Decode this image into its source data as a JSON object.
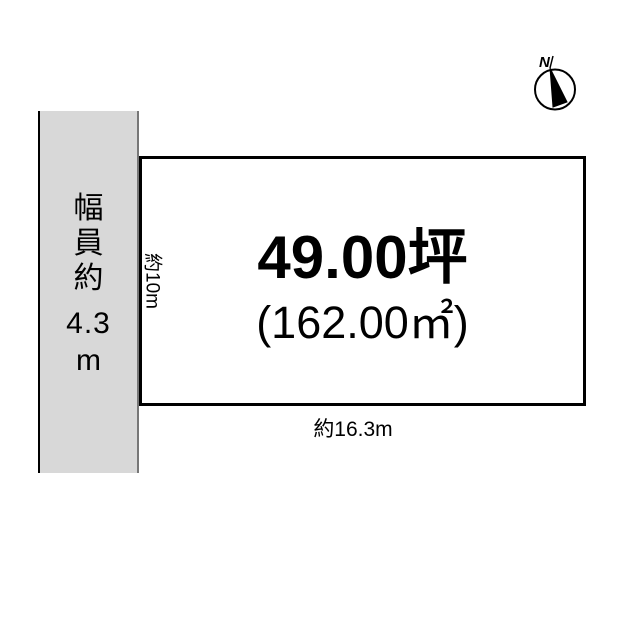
{
  "diagram": {
    "road": {
      "chars": [
        "幅",
        "員",
        "約"
      ],
      "value": "4.3",
      "unit": "m"
    },
    "plot": {
      "area_tsubo": "49.00坪",
      "area_sqm": "(162.00㎡)",
      "depth": "約10m",
      "frontage": "約16.3m"
    },
    "compass": {
      "north_label": "N"
    },
    "colors": {
      "road_fill": "#d8d8d8",
      "outline": "#000000",
      "background": "#ffffff"
    }
  }
}
